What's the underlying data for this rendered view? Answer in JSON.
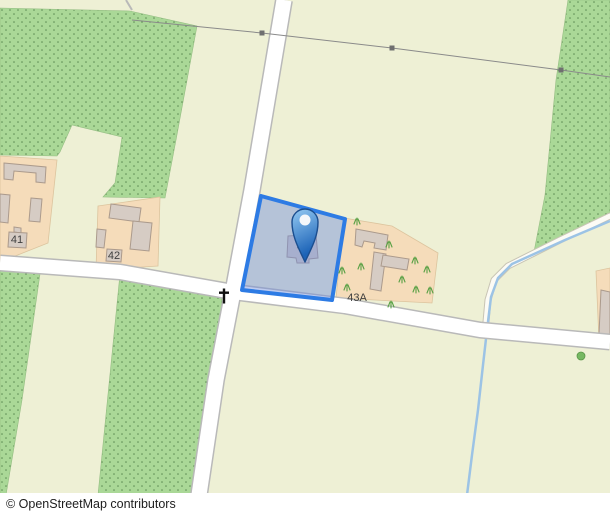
{
  "map": {
    "width": 610,
    "height": 493,
    "colors": {
      "land": "#eef0d5",
      "orchard": "#aad897",
      "orchard_dot": "#41703c",
      "orchard_edge": "#94bd82",
      "farmyard": "#f5dcba",
      "farmyard_edge": "#dcc49e",
      "building": "#d6ccc4",
      "building_edge": "#ab9a8c",
      "road_fill": "#ffffff",
      "road_casing": "#b9b9b9",
      "track_fill": "#fcfbf5",
      "track_casing": "#c8c4b4",
      "stream": "#9cc3e5",
      "power_line": "#8a8a8a",
      "pylon": "#6f6f6f",
      "selection_fill": "rgba(110,140,220,0.45)",
      "selection_stroke": "#2d7be4",
      "pin_light": "#8ec4ef",
      "pin_dark": "#1c63b7",
      "pin_stroke": "#1b4e8f",
      "label": "#3f3f3f",
      "tree_fill": "#76b862",
      "tree_edge": "#5a9648",
      "grass": "#58a044",
      "cross": "#111111"
    },
    "green_areas": [
      {
        "name": "orchard-top-left",
        "points": "0,8 130,11 197,26 176,140 165,198 103,197 115,183 122,137 72,125 60,152 57,156 0,155"
      },
      {
        "name": "orchard-left-strip",
        "points": "0,271 40,274 22,400 6,495 0,495"
      },
      {
        "name": "orchard-lower-middle",
        "points": "120,274 222,296 218,370 199,495 98,495"
      },
      {
        "name": "orchard-right-strip",
        "points": "568,0 610,0 610,218 533,257 545,195 556,80"
      }
    ],
    "parcels": [
      {
        "name": "parcel-41",
        "points": "0,156 57,160 48,243 0,262"
      },
      {
        "name": "parcel-42",
        "points": "98,206 160,197 158,266 96,270"
      },
      {
        "name": "parcel-43a",
        "points": "344,218 392,226 438,253 432,303 336,298"
      },
      {
        "name": "parcel-right-edge",
        "points": "596,271 610,268 610,340 599,341"
      }
    ],
    "buildings": [
      {
        "points": "4,163 46,167 45,183 36,182 36,173 14,171 13,180 4,179"
      },
      {
        "points": "0,194 10,195 8,223 0,222"
      },
      {
        "points": "31,198 42,199 40,222 29,221"
      },
      {
        "points": "14,227 21,228 21,233 14,232"
      },
      {
        "points": "9,232 27,233 26,248 8,247"
      },
      {
        "points": "111,204 141,208 139,222 109,218"
      },
      {
        "points": "133,221 152,223 149,251 130,249"
      },
      {
        "points": "97,229 106,230 104,248 96,247"
      },
      {
        "points": "107,249 122,250 121,262 106,261"
      },
      {
        "points": "288,236 316,234 318,258 309,259 309,263 297,263 296,258 287,257"
      },
      {
        "points": "356,229 388,235 386,250 374,248 375,243 364,241 362,247 355,245"
      },
      {
        "points": "374,252 386,254 381,291 370,289"
      },
      {
        "points": "383,255 409,259 407,270 381,266"
      },
      {
        "points": "601,290 610,292 610,335 599,334"
      }
    ],
    "roads": [
      {
        "name": "road-vertical",
        "points": "284,0 252,190 233,292 216,380 199,495",
        "width": 15
      },
      {
        "name": "road-horizontal",
        "points": "0,263 120,272 233,292 345,306 480,330 610,342",
        "width": 14
      }
    ],
    "road_spur": {
      "points": "126,0 132,10"
    },
    "track": {
      "points": "610,216 560,240 508,266 494,280 488,300 486,322"
    },
    "stream": {
      "points": "610,221 565,240 512,264 498,278 491,297 487,330 483,365 478,410 472,455 467,495"
    },
    "power_line": {
      "points": "132,20 262,33 392,48 561,70 610,77",
      "pylons": [
        [
          262,
          33
        ],
        [
          392,
          48
        ],
        [
          561,
          70
        ]
      ]
    },
    "grass_tufts": [
      [
        357,
        222
      ],
      [
        389,
        245
      ],
      [
        415,
        261
      ],
      [
        342,
        271
      ],
      [
        361,
        267
      ],
      [
        402,
        280
      ],
      [
        416,
        290
      ],
      [
        430,
        291
      ],
      [
        347,
        288
      ],
      [
        391,
        305
      ],
      [
        427,
        270
      ]
    ],
    "tree": {
      "x": 581,
      "y": 356,
      "r": 4
    },
    "wayside_cross": {
      "x": 224,
      "y": 296
    },
    "labels": [
      {
        "name": "housenumber-41",
        "text": "41",
        "x": 17,
        "y": 243
      },
      {
        "name": "housenumber-42",
        "text": "42",
        "x": 114,
        "y": 259
      },
      {
        "name": "housenumber-43",
        "text": "43",
        "x": 303,
        "y": 250
      },
      {
        "name": "housenumber-43a",
        "text": "43A",
        "x": 357,
        "y": 301
      }
    ],
    "selection": {
      "points": "261,196 345,219 332,300 242,290",
      "pin_x": 305,
      "pin_tip_y": 262,
      "pin_head_y": 222,
      "pin_head_r": 13,
      "pin_hole_y": 220,
      "pin_hole_r": 5.5
    }
  },
  "attribution": {
    "text": "© OpenStreetMap contributors"
  }
}
